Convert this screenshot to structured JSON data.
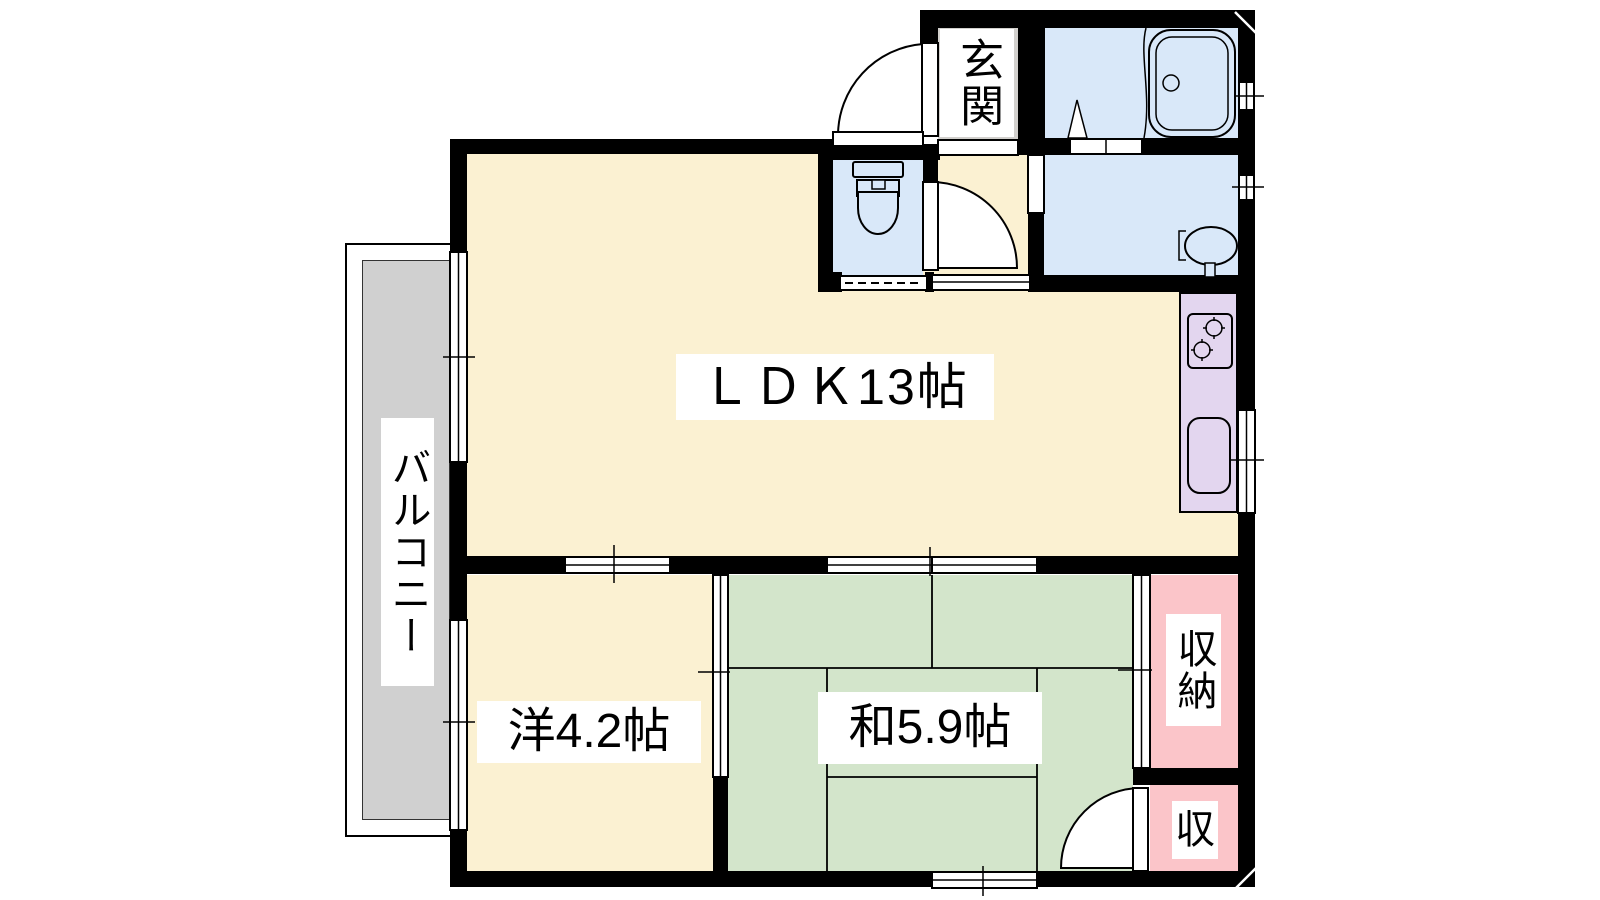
{
  "type": "apartment-floorplan",
  "rooms": {
    "ldk": {
      "label": "ＬＤＫ13帖"
    },
    "western_room": {
      "label": "洋4.2帖"
    },
    "japanese_room": {
      "label": "和5.9帖"
    },
    "balcony": {
      "label": "バルコニー"
    },
    "entrance": {
      "label": "玄関"
    },
    "storage_large": {
      "label": "収納"
    },
    "storage_small": {
      "label": "収"
    }
  },
  "fixtures": [
    "toilet-icon",
    "bathtub-icon",
    "shower-icon",
    "washbasin-icon",
    "stove-icon",
    "kitchen-sink-icon"
  ],
  "colors": {
    "wall": "#000000",
    "room_cream": "#FBF1D2",
    "tatami_green": "#D3E5CB",
    "storage_pink": "#FBC5C9",
    "wet_area_blue": "#D9E8F9",
    "kitchen_lavender": "#E3D6EF",
    "balcony_gray": "#D0D0D0",
    "entrance_gray": "#D2D0CD",
    "label_bg": "#FFFFFF",
    "text": "#000000"
  }
}
